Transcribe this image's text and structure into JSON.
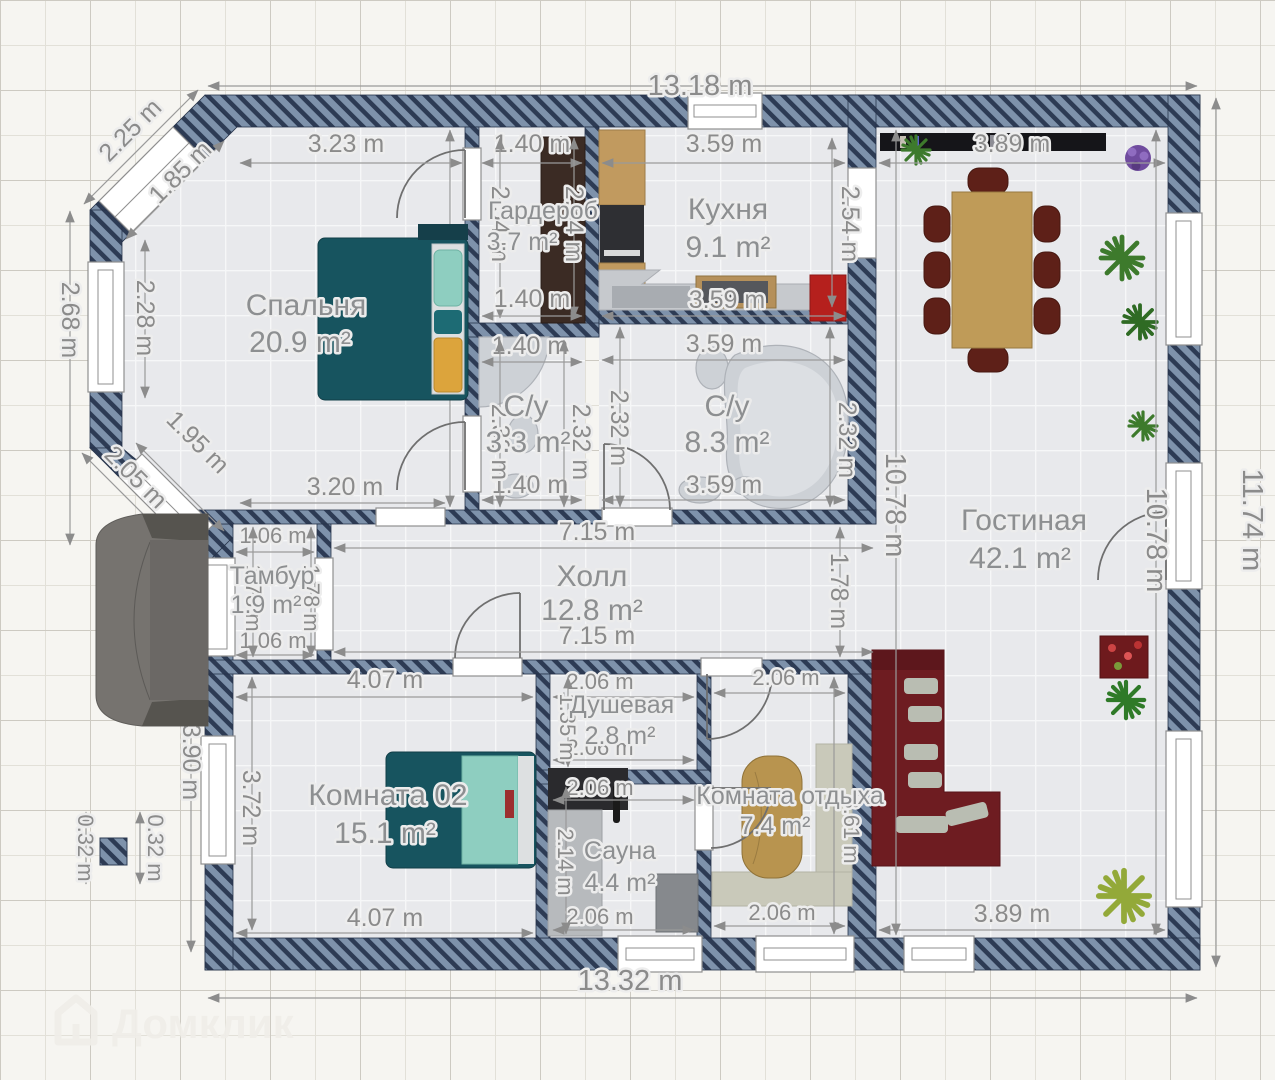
{
  "plan": {
    "rooms": {
      "bedroom": {
        "name": "Спальня",
        "area": "20.9 m²"
      },
      "wardrobe": {
        "name": "Гардероб",
        "area": "3.7 m²"
      },
      "kitchen": {
        "name": "Кухня",
        "area": "9.1 m²"
      },
      "bath_small": {
        "name": "С/у",
        "area": "3.3 m²"
      },
      "bath_large": {
        "name": "С/у",
        "area": "8.3 m²"
      },
      "living": {
        "name": "Гостиная",
        "area": "42.1 m²"
      },
      "hall": {
        "name": "Холл",
        "area": "12.8 m²"
      },
      "vestibule": {
        "name": "Тамбур",
        "area": "1.9 m²"
      },
      "room02": {
        "name": "Комната 02",
        "area": "15.1 m²"
      },
      "shower": {
        "name": "Душевая",
        "area": "2.8 m²"
      },
      "sauna": {
        "name": "Сауна",
        "area": "4.4 m²"
      },
      "lounge": {
        "name": "Комната отдыха",
        "area": "7.4 m²"
      }
    },
    "dims": {
      "overall_top": "13.18 m",
      "overall_bottom": "13.32 m",
      "overall_right": "11.74 m",
      "bay_top_outer": "2.25 m",
      "bay_top_inner": "1.85 m",
      "bedroom_top": "3.23 m",
      "bedroom_bottom": "3.20 m",
      "bedroom_right": "5.00 m",
      "left_outer": "2.68 m",
      "left_inner": "2.28 m",
      "bay_bottom_inner": "1.95 m",
      "bay_bottom_outer": "2.05 m",
      "wardrobe_top": "1.40 m",
      "wardrobe_bottom": "1.40 m",
      "wardrobe_left": "2.54 m",
      "wardrobe_right": "2.54 m",
      "kitchen_top": "3.59 m",
      "kitchen_bottom": "3.59 m",
      "kitchen_right": "2.54 m",
      "bath1_top": "1.40 m",
      "bath1_bottom": "1.40 m",
      "bath1_left": "2.32 m",
      "bath1_right": "2.32 m",
      "bath2_top": "3.59 m",
      "bath2_bottom": "3.59 m",
      "bath2_left": "2.32 m",
      "bath2_right": "2.32 m",
      "living_top": "3.89 m",
      "living_bottom": "3.89 m",
      "living_height_left": "10.78 m",
      "living_height_right": "10.78 m",
      "hall_top": "7.15 m",
      "hall_bottom": "7.15 m",
      "hall_right": "1.78 m",
      "tambur_top": "1.06 m",
      "tambur_bottom": "1.06 m",
      "tambur_left": "1.78 m",
      "tambur_right": "1.78 m",
      "room02_top": "4.07 m",
      "room02_bottom": "4.07 m",
      "room02_left": "3.72 m",
      "room02_left_outer": "3.90 m",
      "shower_top": "2.06 m",
      "shower_bottom": "2.06 m",
      "shower_left": "1.35 m",
      "sauna_top": "2.06 m",
      "sauna_bottom": "2.06 m",
      "sauna_left": "2.14 m",
      "lounge_top": "2.06 m",
      "lounge_bottom": "2.06 m",
      "lounge_right": "3.61 m",
      "column_left": "0.32 m",
      "column_right": "0.32 m"
    }
  },
  "watermark": {
    "text": "Домклик"
  },
  "colors": {
    "paper": "#f6f5f1",
    "floor": "#e8e9ec",
    "wall_base": "#7e92ab",
    "wall_stripe": "#2d3b54",
    "dim_text": "#8b8b8b",
    "bed_teal": "#17545f",
    "pillow_mint": "#8ecec0",
    "blanket_yellow": "#dca43c",
    "sofa_red": "#6e1c21",
    "fridge_red": "#b5201d",
    "wood": "#b8944f",
    "closet_brown": "#3b2b24"
  }
}
